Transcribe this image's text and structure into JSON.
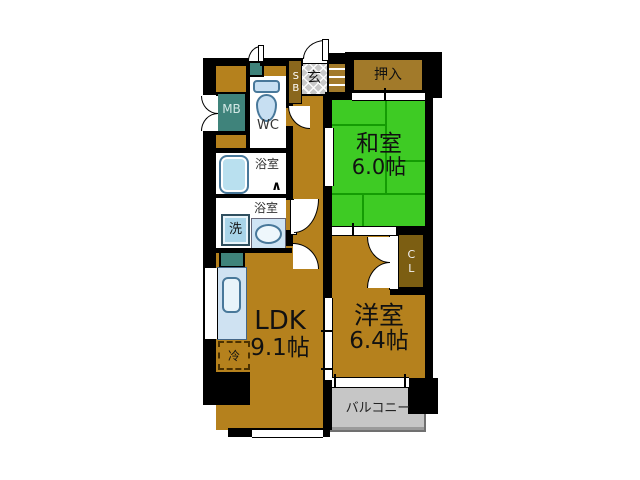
{
  "rooms": {
    "washitsu": {
      "name": "和室",
      "size": "6.0帖"
    },
    "yoshitsu": {
      "name": "洋室",
      "size": "6.4帖"
    },
    "ldk": {
      "name": "LDK",
      "size": "9.1帖"
    },
    "oshiire": {
      "label": "押入"
    },
    "closet": {
      "label": "CL"
    },
    "balcony": {
      "label": "バルコニー"
    },
    "bath": {
      "label": "浴室"
    },
    "washroom": {
      "label": "浴室"
    },
    "wc": {
      "label": "WC"
    },
    "genkan": {
      "label": "玄"
    },
    "meter_box": {
      "label": "MB"
    },
    "shoe_box": {
      "label": "SB"
    },
    "washer": {
      "label": "洗"
    },
    "fridge": {
      "label": "冷"
    },
    "bath_door_mark": {
      "label": "∧"
    }
  },
  "colors": {
    "floor": "#b5811d",
    "tatami": "#3ecb24",
    "tatami_line": "#149c04",
    "wall": "#000000",
    "balcony": "#c6c6c6",
    "genkan_tile": "#c9c9c9",
    "utility_teal": "#3f837b",
    "fixture_blue": "#c7dff2",
    "oshiire_brown": "#a27a2a",
    "closet_brown": "#7c5e12"
  }
}
